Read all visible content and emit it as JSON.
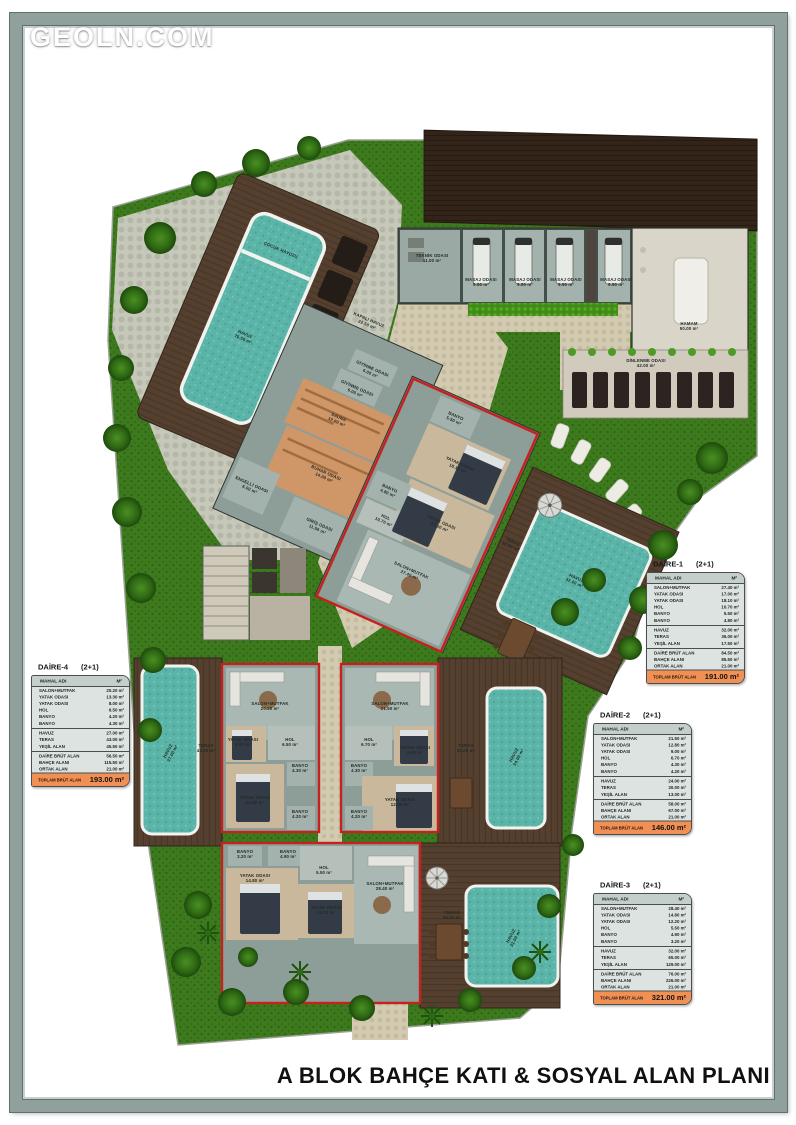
{
  "watermark": "GEOLN.COM",
  "plan_title": "A BLOK BAHÇE KATI & SOSYAL ALAN PLANI",
  "colors": {
    "unit_outline": "#c8201d",
    "pool_water": "#5bb4a8",
    "wood_deck": "#55402f",
    "grass": "#3c7a1d",
    "table_total_bar": "#f09055",
    "table_bg": "#dde3e0",
    "table_header": "#c4cecb"
  },
  "apartment_tables": {
    "header": {
      "name_col": "MAHAL ADI",
      "area_col": "M²"
    },
    "total_label": "TOPLAM BRÜT ALAN",
    "units": [
      {
        "id": "daire-1",
        "name": "DAİRE-1",
        "type": "(2+1)",
        "pos": [
          646,
          560
        ],
        "groups": [
          [
            [
              "SALON+MUTFAK",
              "27.40 m²"
            ],
            [
              "YATAK ODASI",
              "17.00 m²"
            ],
            [
              "YATAK ODASI",
              "18.10 m²"
            ],
            [
              "HOL",
              "10.70 m²"
            ],
            [
              "BANYO",
              "5.50 m²"
            ],
            [
              "BANYO",
              "4.80 m²"
            ]
          ],
          [
            [
              "HAVUZ",
              "32.00 m²"
            ],
            [
              "TERAS",
              "36.00 m²"
            ],
            [
              "YEŞİL ALAN",
              "17.50 m²"
            ]
          ],
          [
            [
              "DAİRE BRÜT ALAN",
              "84.50 m²"
            ],
            [
              "BAHÇE ALANI",
              "85.50 m²"
            ],
            [
              "ORTAK ALAN",
              "21.00 m²"
            ]
          ]
        ],
        "total": "191.00 m²"
      },
      {
        "id": "daire-2",
        "name": "DAİRE-2",
        "type": "(2+1)",
        "pos": [
          593,
          711
        ],
        "groups": [
          [
            [
              "SALON+MUTFAK",
              "21.50 m²"
            ],
            [
              "YATAK ODASI",
              "12.80 m²"
            ],
            [
              "YATAK ODASI",
              "9.00 m²"
            ],
            [
              "HOL",
              "6.70 m²"
            ],
            [
              "BANYO",
              "4.30 m²"
            ],
            [
              "BANYO",
              "4.20 m²"
            ]
          ],
          [
            [
              "HAVUZ",
              "24.00 m²"
            ],
            [
              "TERAS",
              "30.00 m²"
            ],
            [
              "YEŞİL ALAN",
              "13.00 m²"
            ]
          ],
          [
            [
              "DAİRE BRÜT ALAN",
              "58.00 m²"
            ],
            [
              "BAHÇE ALANI",
              "67.00 m²"
            ],
            [
              "ORTAK ALAN",
              "21.00 m²"
            ]
          ]
        ],
        "total": "146.00 m²"
      },
      {
        "id": "daire-3",
        "name": "DAİRE-3",
        "type": "(2+1)",
        "pos": [
          593,
          881
        ],
        "groups": [
          [
            [
              "SALON+MUTFAK",
              "28.40 m²"
            ],
            [
              "YATAK ODASI",
              "14.80 m²"
            ],
            [
              "YATAK ODASI",
              "12.20 m²"
            ],
            [
              "HOL",
              "5.50 m²"
            ],
            [
              "BANYO",
              "4.90 m²"
            ],
            [
              "BANYO",
              "3.20 m²"
            ]
          ],
          [
            [
              "HAVUZ",
              "32.00 m²"
            ],
            [
              "TERAS",
              "65.00 m²"
            ],
            [
              "YEŞİL ALAN",
              "129.00 m²"
            ]
          ],
          [
            [
              "DAİRE BRÜT ALAN",
              "76.00 m²"
            ],
            [
              "BAHÇE ALANI",
              "226.00 m²"
            ],
            [
              "ORTAK ALAN",
              "21.00 m²"
            ]
          ]
        ],
        "total": "321.00 m²"
      },
      {
        "id": "daire-4",
        "name": "DAİRE-4",
        "type": "(2+1)",
        "pos": [
          31,
          663
        ],
        "groups": [
          [
            [
              "SALON+MUTFAK",
              "20.20 m²"
            ],
            [
              "YATAK ODASI",
              "13.30 m²"
            ],
            [
              "YATAK ODASI",
              "8.00 m²"
            ],
            [
              "HOL",
              "6.50 m²"
            ],
            [
              "BANYO",
              "4.20 m²"
            ],
            [
              "BANYO",
              "4.30 m²"
            ]
          ],
          [
            [
              "HAVUZ",
              "27.00 m²"
            ],
            [
              "TERAS",
              "43.00 m²"
            ],
            [
              "YEŞİL ALAN",
              "45.50 m²"
            ]
          ],
          [
            [
              "DAİRE BRÜT ALAN",
              "56.50 m²"
            ],
            [
              "BAHÇE ALANI",
              "115.50 m²"
            ],
            [
              "ORTAK ALAN",
              "21.00 m²"
            ]
          ]
        ],
        "total": "193.00 m²"
      }
    ]
  },
  "plan_labels": [
    {
      "x": 432,
      "y": 258,
      "t": [
        "TEKNİK ODASI",
        "11.00 m²"
      ]
    },
    {
      "x": 481,
      "y": 282,
      "t": [
        "MASAJ ODASI",
        "9.50 m²"
      ],
      "s": 3.8
    },
    {
      "x": 525,
      "y": 282,
      "t": [
        "MASAJ ODASI",
        "9.50 m²"
      ],
      "s": 3.8
    },
    {
      "x": 566,
      "y": 282,
      "t": [
        "MASAJ ODASI",
        "9.50 m²"
      ],
      "s": 3.8
    },
    {
      "x": 616,
      "y": 282,
      "t": [
        "MASAJ ODASI",
        "9.50 m²"
      ],
      "s": 3.8
    },
    {
      "x": 689,
      "y": 326,
      "s": 5.5,
      "t": [
        "HAMAM",
        "50.00 m²"
      ]
    },
    {
      "x": 646,
      "y": 363,
      "t": [
        "DİNLENME ODASI",
        "42.00 m²"
      ]
    },
    {
      "x": 368,
      "y": 322,
      "r": 23,
      "c": "#2a1f12",
      "t": [
        "KAPALI HAVUZ",
        "22.50 m²"
      ]
    },
    {
      "x": 270,
      "y": 706,
      "t": [
        "SALON+MUTFAK",
        "20.20 m²"
      ]
    },
    {
      "x": 243,
      "y": 742,
      "s": 3.7,
      "t": [
        "YATAK ODASI",
        "8.00 m²"
      ]
    },
    {
      "x": 290,
      "y": 742,
      "t": [
        "HOL",
        "6.50 m²"
      ]
    },
    {
      "x": 300,
      "y": 768,
      "s": 3.5,
      "t": [
        "BANYO",
        "4.30 m²"
      ]
    },
    {
      "x": 255,
      "y": 800,
      "t": [
        "YATAK ODASI",
        "13.30 m²"
      ]
    },
    {
      "x": 300,
      "y": 814,
      "s": 3.5,
      "t": [
        "BANYO",
        "4.20 m²"
      ]
    },
    {
      "x": 206,
      "y": 748,
      "c": "#241c12",
      "t": [
        "TERAS",
        "43.00 m²"
      ]
    },
    {
      "x": 170,
      "y": 752,
      "r": -62,
      "c": "#15443e",
      "t": [
        "HAVUZ",
        "27.00 m²"
      ]
    },
    {
      "x": 390,
      "y": 706,
      "t": [
        "SALON+MUTFAK",
        "21.50 m²"
      ]
    },
    {
      "x": 369,
      "y": 742,
      "t": [
        "HOL",
        "6.70 m²"
      ]
    },
    {
      "x": 359,
      "y": 768,
      "s": 3.5,
      "t": [
        "BANYO",
        "4.30 m²"
      ]
    },
    {
      "x": 415,
      "y": 750,
      "s": 3.7,
      "t": [
        "YATAK ODASI",
        "9.00 m²"
      ]
    },
    {
      "x": 400,
      "y": 802,
      "t": [
        "YATAK ODASI",
        "12.80 m²"
      ]
    },
    {
      "x": 359,
      "y": 814,
      "s": 3.5,
      "t": [
        "BANYO",
        "4.20 m²"
      ]
    },
    {
      "x": 466,
      "y": 748,
      "c": "#241c12",
      "t": [
        "TERAS",
        "30.00 m²"
      ]
    },
    {
      "x": 516,
      "y": 756,
      "r": -62,
      "c": "#15443e",
      "t": [
        "HAVUZ",
        "24.00 m²"
      ]
    },
    {
      "x": 245,
      "y": 854,
      "s": 3.5,
      "t": [
        "BANYO",
        "3.20 m²"
      ]
    },
    {
      "x": 288,
      "y": 854,
      "s": 3.5,
      "t": [
        "BANYO",
        "4.90 m²"
      ]
    },
    {
      "x": 255,
      "y": 878,
      "t": [
        "YATAK ODASI",
        "14.80 m²"
      ]
    },
    {
      "x": 324,
      "y": 870,
      "t": [
        "HOL",
        "5.50 m²"
      ]
    },
    {
      "x": 326,
      "y": 910,
      "t": [
        "YATAK ODASI",
        "12.20 m²"
      ]
    },
    {
      "x": 385,
      "y": 886,
      "t": [
        "SALON+MUTFAK",
        "28.40 m²"
      ]
    },
    {
      "x": 452,
      "y": 915,
      "c": "#241c12",
      "t": [
        "TERAS",
        "65.00 m²"
      ]
    },
    {
      "x": 513,
      "y": 937,
      "r": -62,
      "c": "#15443e",
      "t": [
        "HAVUZ",
        "32.00 m²"
      ]
    },
    {
      "g": "pool",
      "x": 252,
      "y": 244,
      "s": 3.6,
      "c": "#16524a",
      "t": [
        "ÇOCUK HAVUZU"
      ]
    },
    {
      "g": "pool",
      "x": 252,
      "y": 338,
      "s": 5,
      "c": "#16524a",
      "t": [
        "HAVUZ",
        "75.50 m²"
      ]
    },
    {
      "g": "wing",
      "x": 341,
      "y": 366,
      "s": 3.7,
      "t": [
        "GİYİNME ODASI",
        "6.00 m²"
      ]
    },
    {
      "g": "wing",
      "x": 335,
      "y": 390,
      "s": 3.7,
      "t": [
        "GİYİNME ODASI",
        "6.00 m²"
      ]
    },
    {
      "g": "wing",
      "x": 330,
      "y": 424,
      "c": "#3c2a12",
      "t": [
        "SAUNA",
        "12.00 m²"
      ]
    },
    {
      "g": "wing",
      "x": 341,
      "y": 480,
      "c": "#3c2a12",
      "t": [
        "BUHAR ODASI",
        "14.00 m²"
      ]
    },
    {
      "g": "wing",
      "x": 278,
      "y": 521,
      "s": 3.7,
      "t": [
        "ENGELLİ ODASI",
        "6.00 m²"
      ]
    },
    {
      "g": "wing",
      "x": 356,
      "y": 530,
      "s": 3.7,
      "t": [
        "GİRİŞ ODASI",
        "11.50 m²"
      ]
    },
    {
      "g": "u1",
      "x": 414,
      "y": 429,
      "s": 3.5,
      "t": [
        "BANYO",
        "5.50 m²"
      ]
    },
    {
      "g": "u1",
      "x": 437,
      "y": 471,
      "t": [
        "YATAK ODASI",
        "18.10 m²"
      ]
    },
    {
      "g": "u1",
      "x": 444,
      "y": 532,
      "t": [
        "YATAK ODASI",
        "17.00 m²"
      ]
    },
    {
      "g": "u1",
      "x": 383,
      "y": 522,
      "s": 3.5,
      "t": [
        "BANYO",
        "4.80 m²"
      ]
    },
    {
      "g": "u1",
      "x": 391,
      "y": 550,
      "t": [
        "HOL",
        "10.70 m²"
      ]
    },
    {
      "g": "u1",
      "x": 436,
      "y": 588,
      "t": [
        "SALON+MUTFAK",
        "27.40 m²"
      ]
    },
    {
      "g": "u1",
      "x": 517,
      "y": 521,
      "c": "#241c12",
      "t": [
        "TERAS",
        "36.00 m²"
      ]
    },
    {
      "g": "u1",
      "x": 590,
      "y": 528,
      "c": "#15443e",
      "t": [
        "HAVUZ",
        "32.00 m²"
      ]
    }
  ]
}
